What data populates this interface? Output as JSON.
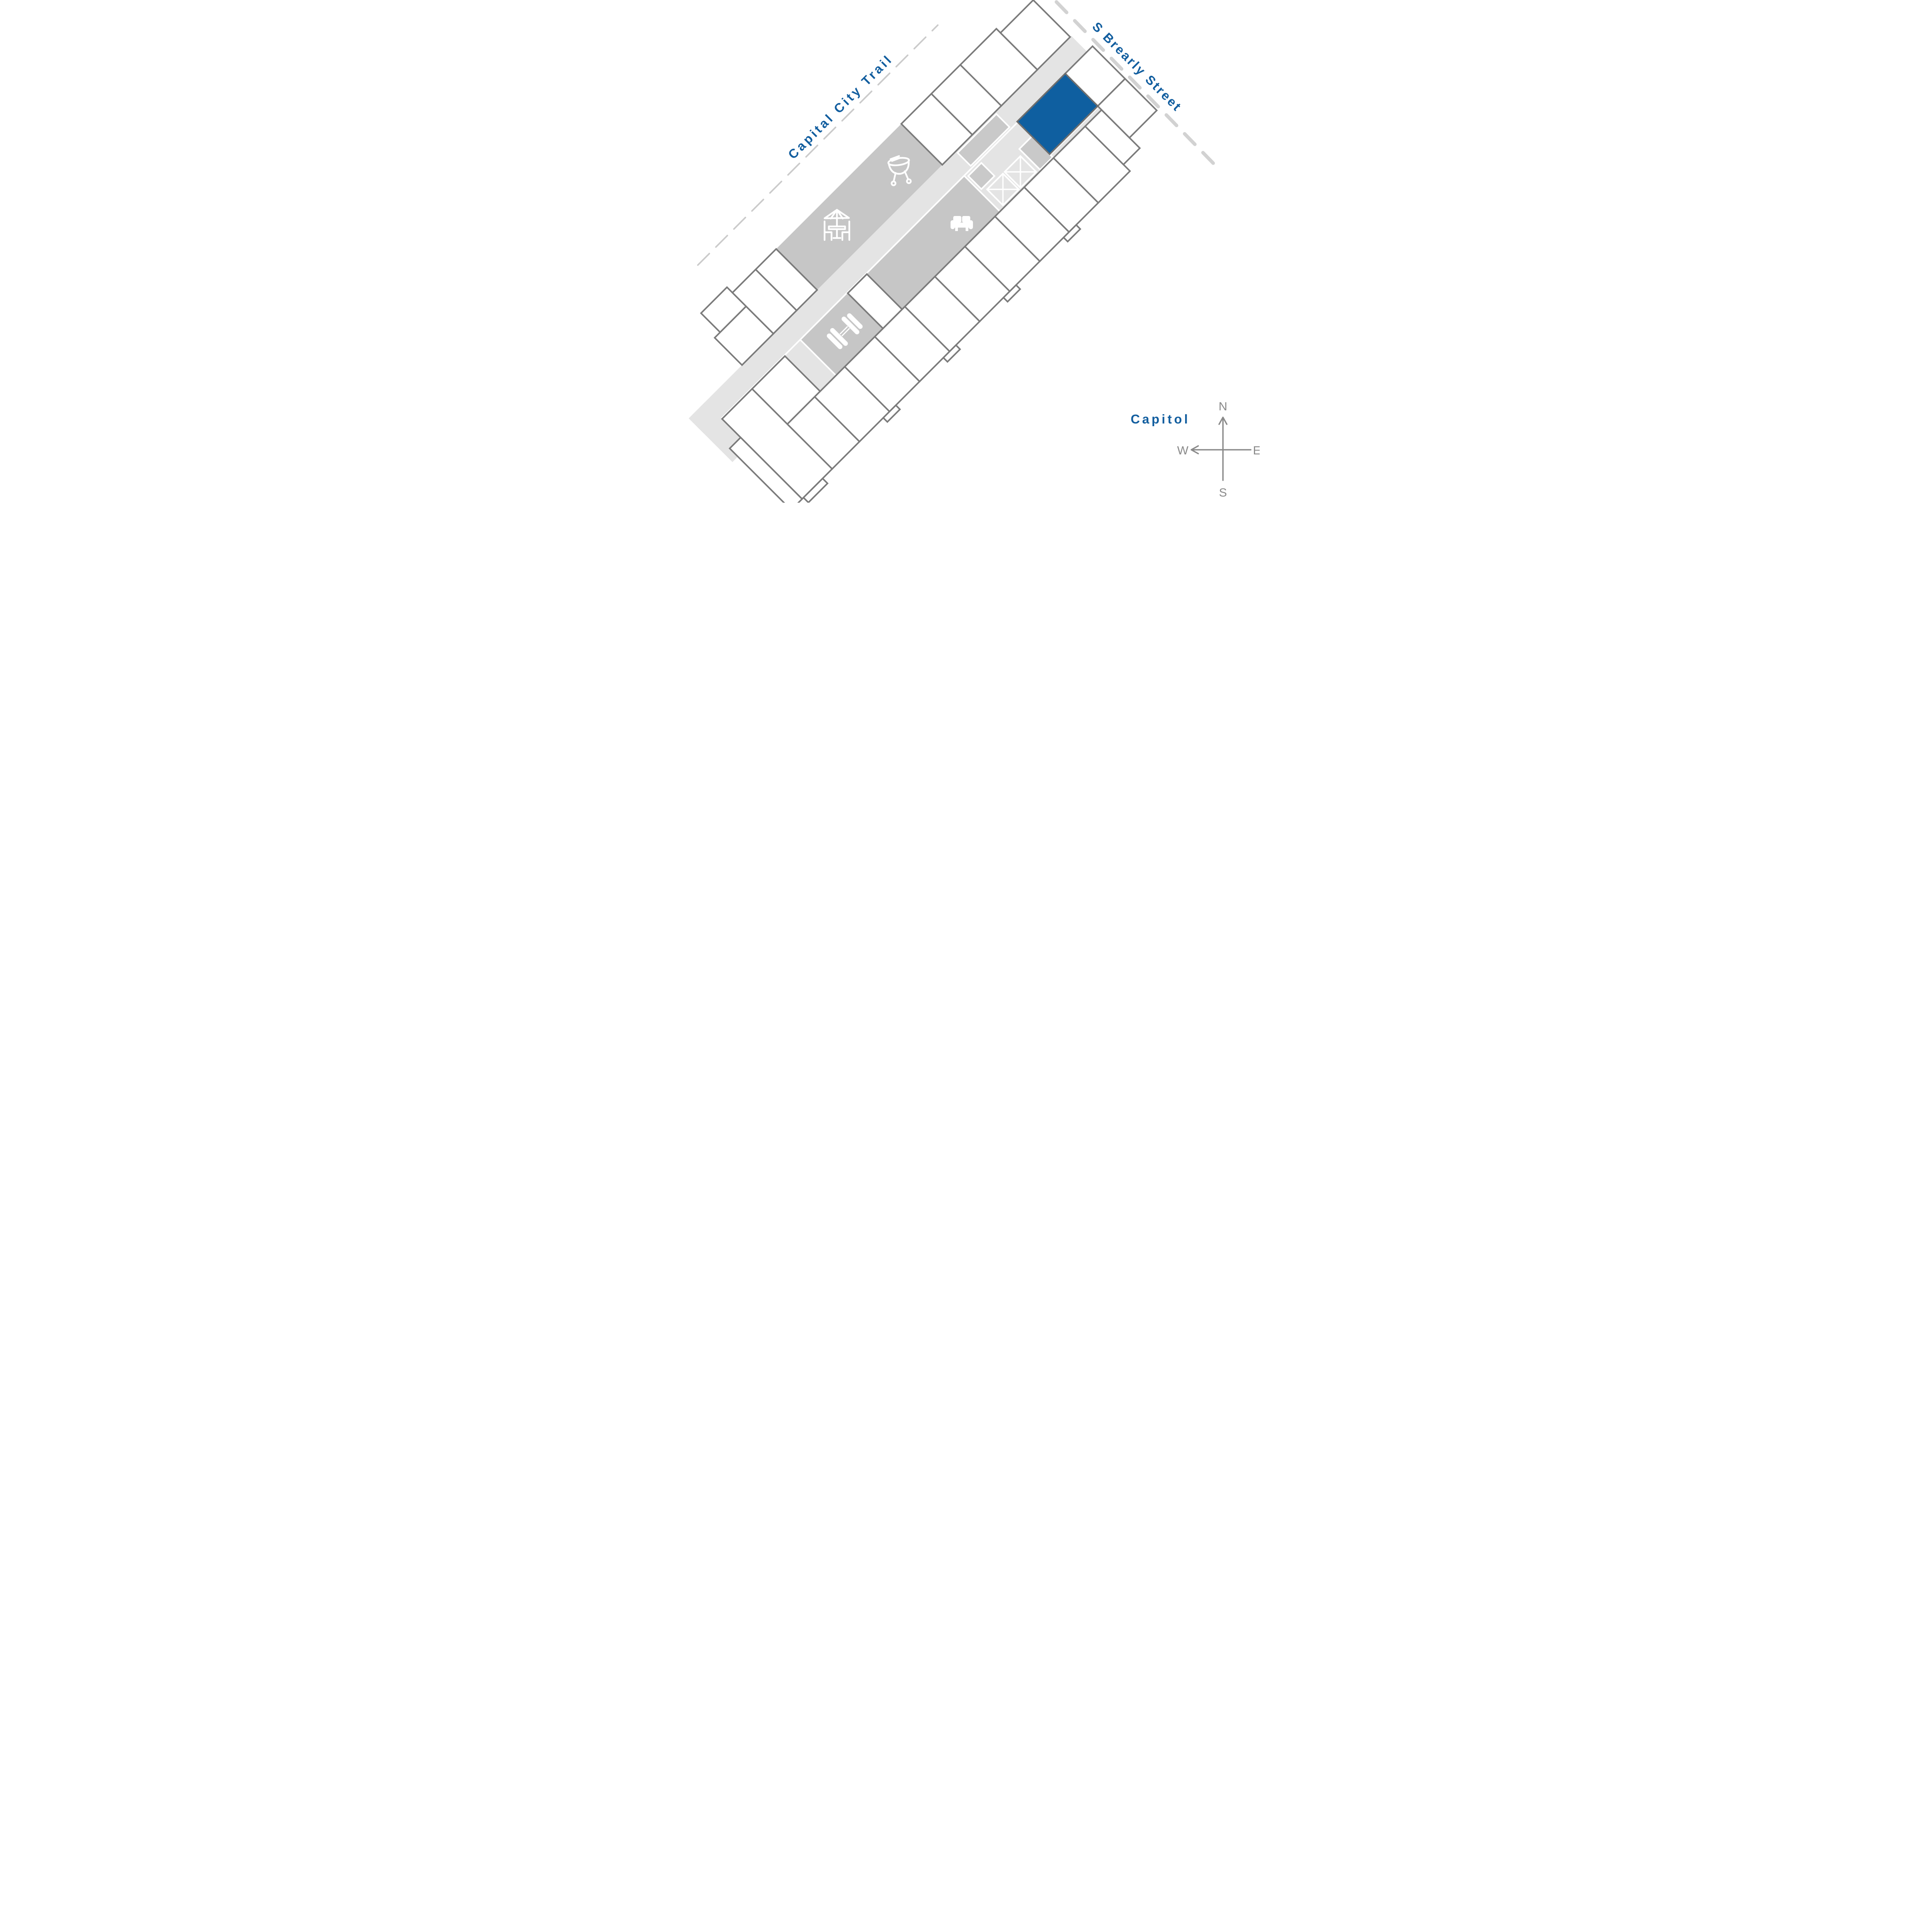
{
  "map": {
    "title": "apartment-site-plan",
    "labels": {
      "trail": "Capital City Trail",
      "street": "S Brearly Street",
      "capitol": "Capitol"
    },
    "compass": {
      "north": "N",
      "south": "S",
      "east": "E",
      "west": "W"
    },
    "highlighted_unit": {
      "count": 1,
      "color": "#0f5fa0",
      "location": "northeast corner facing S Brearly Street"
    },
    "units_total_visible": 27,
    "amenities": [
      {
        "name": "grill-icon",
        "area": "patio"
      },
      {
        "name": "patio-table-umbrella-icon",
        "area": "patio"
      },
      {
        "name": "sofa-icon",
        "area": "lounge"
      },
      {
        "name": "stair-x-boxes-icon",
        "area": "corridor-core"
      },
      {
        "name": "dumbbell-icon",
        "area": "gym"
      }
    ],
    "colors": {
      "highlight_blue": "#0f5fa0",
      "label_blue": "#125e9f",
      "unit_outline_gray": "#7b7b7b",
      "amenity_gray": "#c6c6c6",
      "corridor_gray": "#e4e4e4",
      "furniture_gray": "#c9c9c9",
      "trail_dash_gray": "#cbcbcb",
      "street_dash_gray": "#d2d2d2",
      "compass_gray": "#8a8a8a",
      "background": "#ffffff"
    }
  }
}
